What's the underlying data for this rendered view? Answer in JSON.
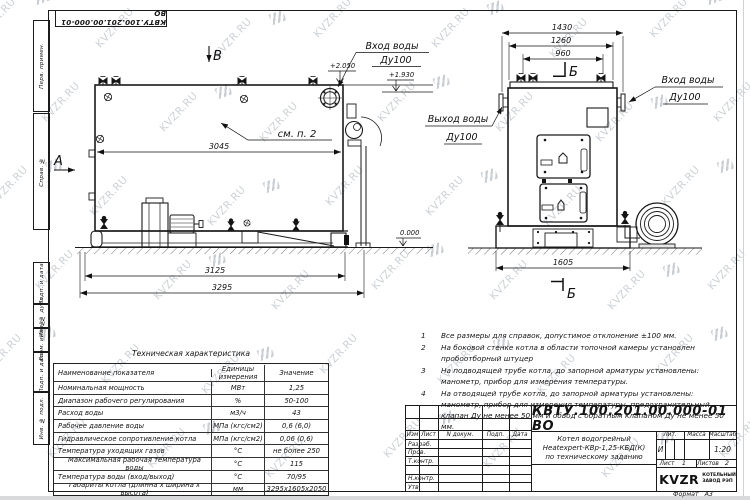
{
  "watermark": {
    "text": "KVZR.RU"
  },
  "margin_labels": {
    "perv": "Перв. примен.",
    "sprav": "Справ. №",
    "podp1": "Подп. и дата",
    "inv_dubl": "Инв. № дубл.",
    "vzam": "Взам. инв. №",
    "podp2": "Подп. и дата",
    "inv_podl": "Инв. № подл."
  },
  "side_view": {
    "view_top": "В",
    "view_left": "А",
    "note_ref": "см. п. 2",
    "inlet_label": "Вход воды",
    "inlet_dn": "Ду100",
    "elev_top": "+2.050",
    "elev_nozzle": "+1.930",
    "elev_zero": "0.000",
    "dim_inner": "3045",
    "dim_base": "3125",
    "dim_overall": "3295"
  },
  "front_view": {
    "section_label_top": "Б",
    "section_label_bottom": "Б",
    "outlet_label": "Выход воды",
    "outlet_dn": "Ду100",
    "inlet_label": "Вход воды",
    "inlet_dn": "Ду100",
    "dim_overall": "1430",
    "dim_body": "1260",
    "dim_valves": "960",
    "dim_base": "1605"
  },
  "notes": {
    "items": [
      {
        "num": "1",
        "text": "Все размеры для справок, допустимое отклонение  ±100 мм."
      },
      {
        "num": "2",
        "text": "На боковой стенке котла в области топочной камеры установлен пробоотборный штуцер"
      },
      {
        "num": "3",
        "text": "На  подводящей трубе котла, до запорной арматуры установлены: манометр, прибор для измерения температуры."
      },
      {
        "num": "4",
        "text": "На отводящей трубе котла, до запорной арматуры установлены: манометр, прибор для измерения температуры, предохранительный клапан Ду не менее 50 мм и обвод с обратным клапаном Ду не менее 50 мм."
      }
    ]
  },
  "spec_table": {
    "title": "Техническая характеристика",
    "headers": [
      "Наименование показателя",
      "Единицы измерения",
      "Значение"
    ],
    "rows": [
      [
        "Номинальная мощность",
        "МВт",
        "1,25"
      ],
      [
        "Диапазон рабочего регулирования",
        "%",
        "50-100"
      ],
      [
        "Расход воды",
        "м3/ч",
        "43"
      ],
      [
        "Рабочее давление воды",
        "МПа (кгс/см2)",
        "0,6 (6,0)"
      ],
      [
        "Гидравлическое сопротивление котла",
        "МПа (кгс/см2)",
        "0,06 (0,6)"
      ],
      [
        "Температура уходящих газов",
        "°С",
        "не более 250"
      ],
      [
        "Максимальная рабочая температура воды",
        "°С",
        "115"
      ],
      [
        "Температура воды (вход/выход)",
        "°С",
        "70/95"
      ],
      [
        "Габариты котла (длинна х ширина х высота)",
        "мм",
        "3295х1605х2050"
      ]
    ]
  },
  "title_block": {
    "doc_number": "КВТУ.100.201.00.000-01 ВО",
    "cols": [
      "Изм",
      "Лист",
      "N докум.",
      "Подп.",
      "Дата"
    ],
    "rows": [
      "Разраб.",
      "Пров.",
      "Т.контр.",
      "",
      "Н.контр.",
      "Утв."
    ],
    "name_lines": [
      "Котел водогрейный",
      "Heatexpert-КВр-1,25-КБД(К)",
      "по техническому заданию"
    ],
    "lit_label": "Лит.",
    "lit_value": "И",
    "mass_label": "Масса",
    "scale_label": "Масштаб",
    "scale_value": "1:20",
    "sheet_label": "Лист",
    "sheet_value": "1",
    "sheets_label": "Листов",
    "sheets_value": "2",
    "logo_text": "KVZR",
    "company_lines": [
      "КОТЕЛЬНЫЙ",
      "ЗАВОД РЭП"
    ],
    "format_label": "Формат",
    "format_value": "А3"
  }
}
